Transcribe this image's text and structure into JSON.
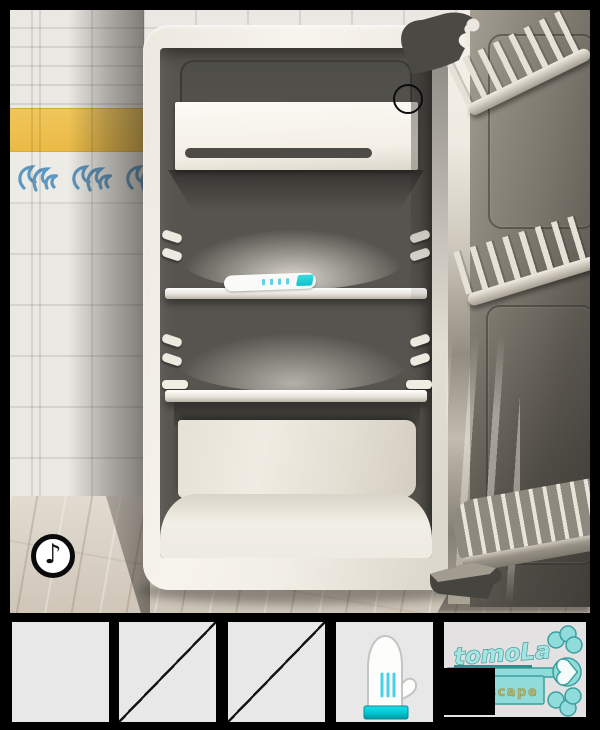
{
  "scene": {
    "music_button": {
      "icon": "♪"
    },
    "fridge": {
      "state": "open",
      "interior_items": [
        "tube"
      ],
      "shelf_count": 2
    }
  },
  "inventory": {
    "slots": [
      {
        "index": 1,
        "state": "empty"
      },
      {
        "index": 2,
        "state": "crossed"
      },
      {
        "index": 3,
        "state": "crossed"
      },
      {
        "index": 4,
        "state": "item",
        "item": "oven-mitt"
      }
    ],
    "logo": {
      "title": "tomoLa",
      "subtitle": "escape"
    }
  },
  "colors": {
    "accent_cyan": "#00d6de",
    "key_teal": "#8fdcda",
    "key_outline": "#3c9e9e",
    "tile_yellow": "#eaba45",
    "tile_blue": "#5e97c0",
    "slot_bg": "#e8e8e8"
  }
}
